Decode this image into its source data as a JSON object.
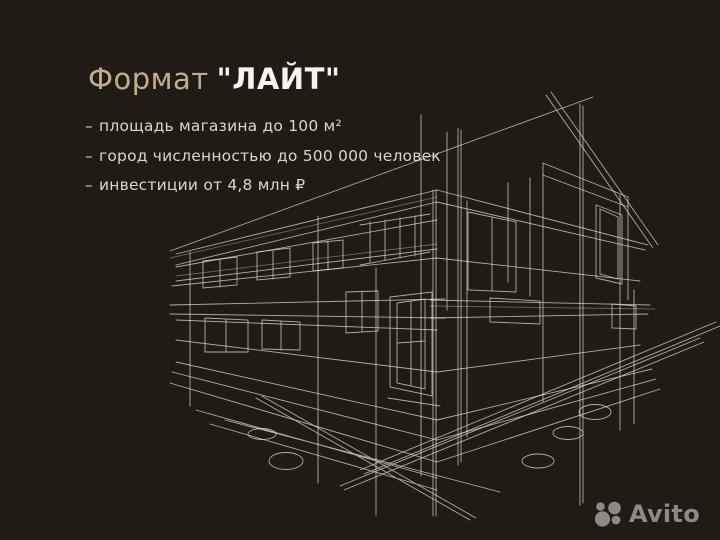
{
  "slide": {
    "title": {
      "accent": "Формат",
      "highlight": "\"ЛАЙТ\""
    },
    "bullets": [
      {
        "marker": "–",
        "text": "площадь магазина до 100 м²"
      },
      {
        "marker": "–",
        "text": "город численностью до 500 000 человек"
      },
      {
        "marker": "–",
        "text": "инвестиции от 4,8 млн ₽"
      }
    ],
    "watermark": {
      "brand": "Avito"
    },
    "illustration": {
      "name": "building-wireframe-sketch"
    },
    "colors": {
      "background": "#211b15",
      "title_accent": "#c2ae8d",
      "title_highlight": "#f6f4f1",
      "bullet_text": "#ded6c5",
      "wireframe_line": "#e2ddd6",
      "watermark_gray": "#8c8987"
    }
  }
}
